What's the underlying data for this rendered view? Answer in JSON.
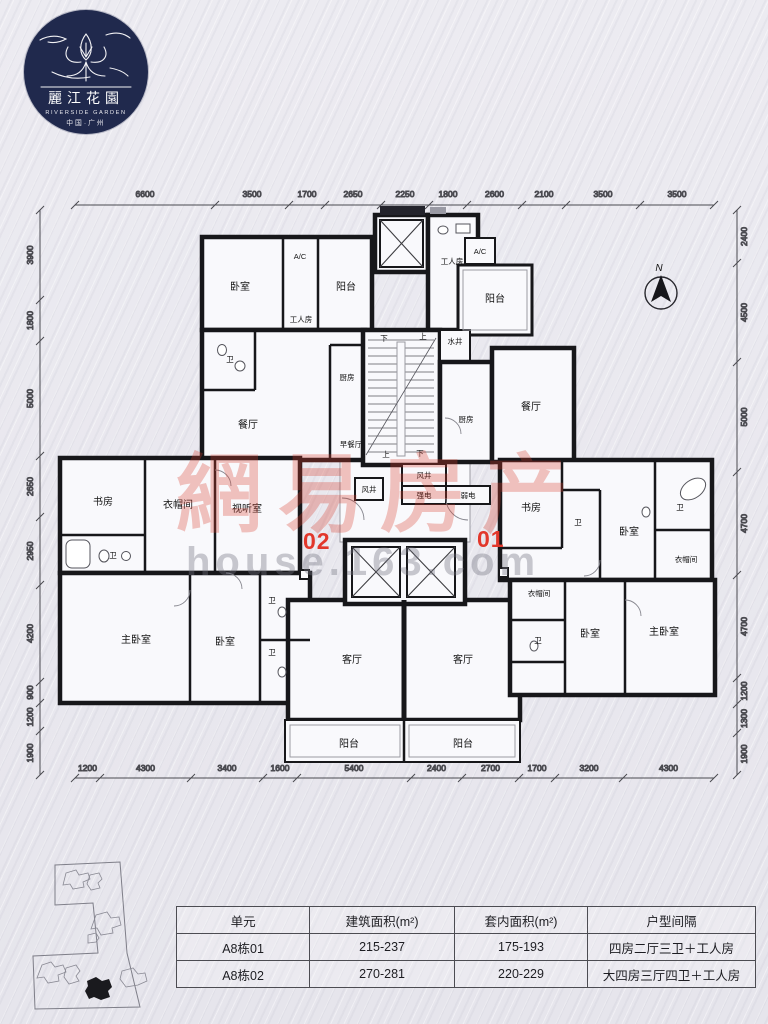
{
  "logo": {
    "title": "麗江花園",
    "subtitle": "RIVERSIDE GARDEN",
    "location": "中国·广州"
  },
  "watermark": {
    "line1": "網易房产",
    "line2": "house.163.com"
  },
  "compass_label": "N",
  "unit_numbers": {
    "left": "02",
    "right": "01"
  },
  "dimensions": {
    "top": [
      "6600",
      "3500",
      "1700",
      "2650",
      "2250",
      "1800",
      "2600",
      "2100",
      "3500",
      "3500"
    ],
    "bottom": [
      "1200",
      "4300",
      "3400",
      "1600",
      "5400",
      "2400",
      "2700",
      "1700",
      "3200",
      "4300"
    ],
    "left": [
      "3900",
      "1800",
      "5000",
      "2650",
      "2950",
      "4200",
      "900",
      "1200",
      "1900"
    ],
    "right": [
      "2400",
      "4500",
      "5000",
      "4700",
      "4700",
      "1200",
      "1300",
      "1900"
    ]
  },
  "rooms": {
    "bedroom_tl": "卧室",
    "ac_tl": "A/C",
    "worker_tl": "工人房",
    "balcony_tl": "阳台",
    "bath_tl": "卫",
    "dining_l": "餐厅",
    "kitchen_l": "厨房",
    "breakfast": "早餐厅",
    "worker_top": "工人房",
    "ac_tr": "A/C",
    "balcony_tr": "阳台",
    "water_shaft": "水井",
    "kitchen_r": "厨房",
    "dining_r": "餐厅",
    "vent1": "风井",
    "vent2": "风井",
    "elec_strong": "强电",
    "elec_weak": "弱电",
    "study_l": "书房",
    "cloak_l": "衣帽间",
    "av_room": "视听室",
    "bath_l1": "卫",
    "master_l": "主卧室",
    "bedroom_l": "卧室",
    "bath_l2": "卫",
    "bath_l3": "卫",
    "living_l": "客厅",
    "living_r": "客厅",
    "balcony_bl": "阳台",
    "balcony_br": "阳台",
    "study_r": "书房",
    "bath_r1": "卫",
    "bedroom_r1": "卧室",
    "bath_r2": "卫",
    "cloak_r1": "衣帽间",
    "cloak_r2": "衣帽间",
    "bath_r3": "卫",
    "bedroom_r2": "卧室",
    "master_r": "主卧室"
  },
  "stairs": {
    "up": "上",
    "down": "下"
  },
  "table": {
    "headers": [
      "单元",
      "建筑面积(m²)",
      "套内面积(m²)",
      "户型间隔"
    ],
    "rows": [
      [
        "A8栋01",
        "215-237",
        "175-193",
        "四房二厅三卫＋工人房"
      ],
      [
        "A8栋02",
        "270-281",
        "220-229",
        "大四房三厅四卫＋工人房"
      ]
    ]
  }
}
